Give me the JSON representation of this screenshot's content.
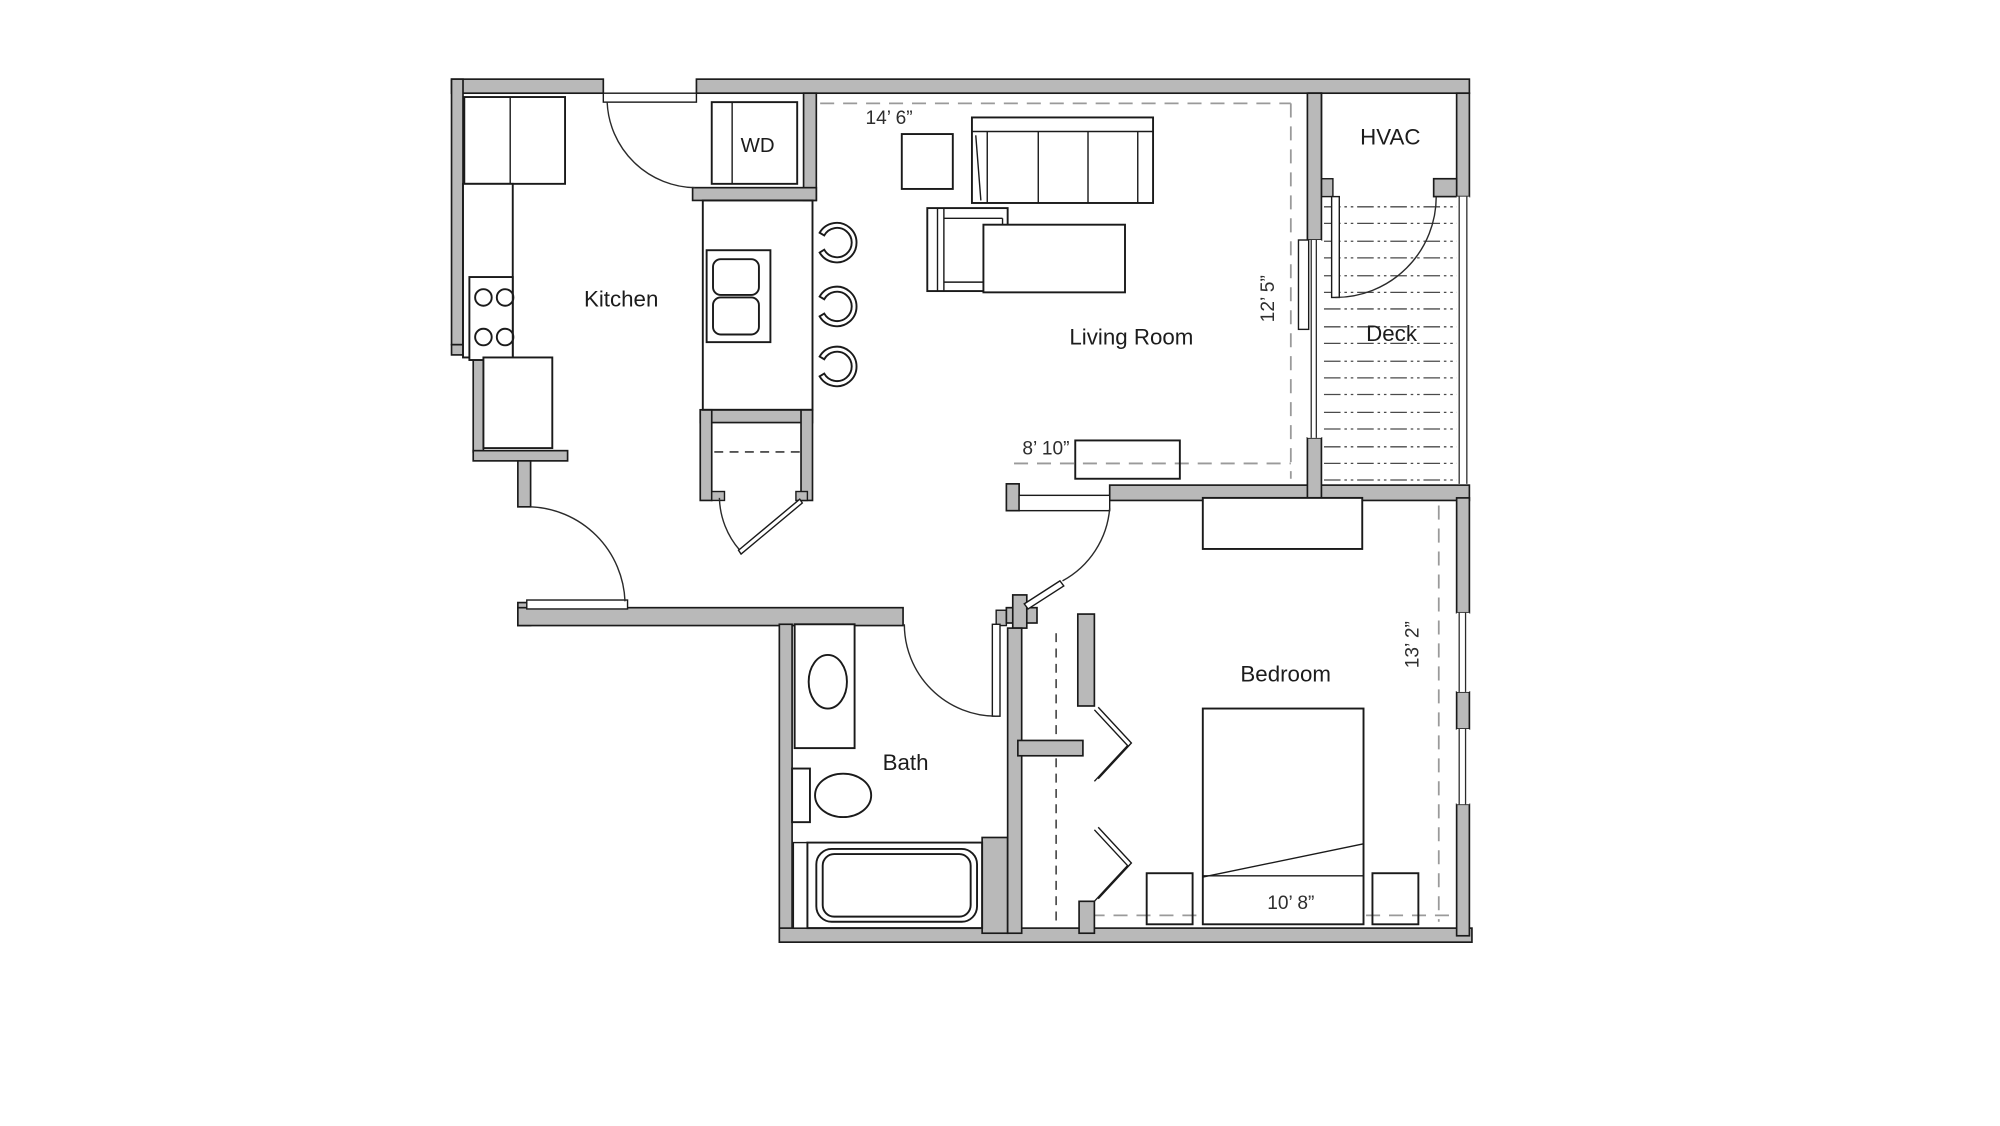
{
  "meta": {
    "drawing_type": "apartment floor plan",
    "background_color": "#ffffff",
    "wall_fill_color": "#b9b9b9",
    "line_color": "#1a1a1a",
    "dimension_line_color": "#9a9a9a"
  },
  "rooms": {
    "kitchen": {
      "label": "Kitchen"
    },
    "living_room": {
      "label": "Living Room"
    },
    "deck": {
      "label": "Deck"
    },
    "hvac": {
      "label": "HVAC"
    },
    "bath": {
      "label": "Bath"
    },
    "bedroom": {
      "label": "Bedroom"
    },
    "washer_dryer": {
      "label": "WD"
    }
  },
  "dimensions": {
    "living_room_width": "14’ 6”",
    "living_room_depth": "12’ 5”",
    "hall_span": "8’ 10”",
    "bedroom_depth": "13’ 2”",
    "bedroom_width": "10’ 8”"
  },
  "fixtures": [
    "refrigerator",
    "range-4-burner",
    "kitchen-counter",
    "island-double-sink",
    "bar-stools-x3",
    "washer-dryer",
    "pantry-closet",
    "sofa-3-seat",
    "armchair",
    "side-table",
    "coffee-table",
    "media-console",
    "dresser",
    "bed",
    "nightstand-x2",
    "closet-bifold",
    "vanity-sink",
    "toilet",
    "bathtub"
  ]
}
